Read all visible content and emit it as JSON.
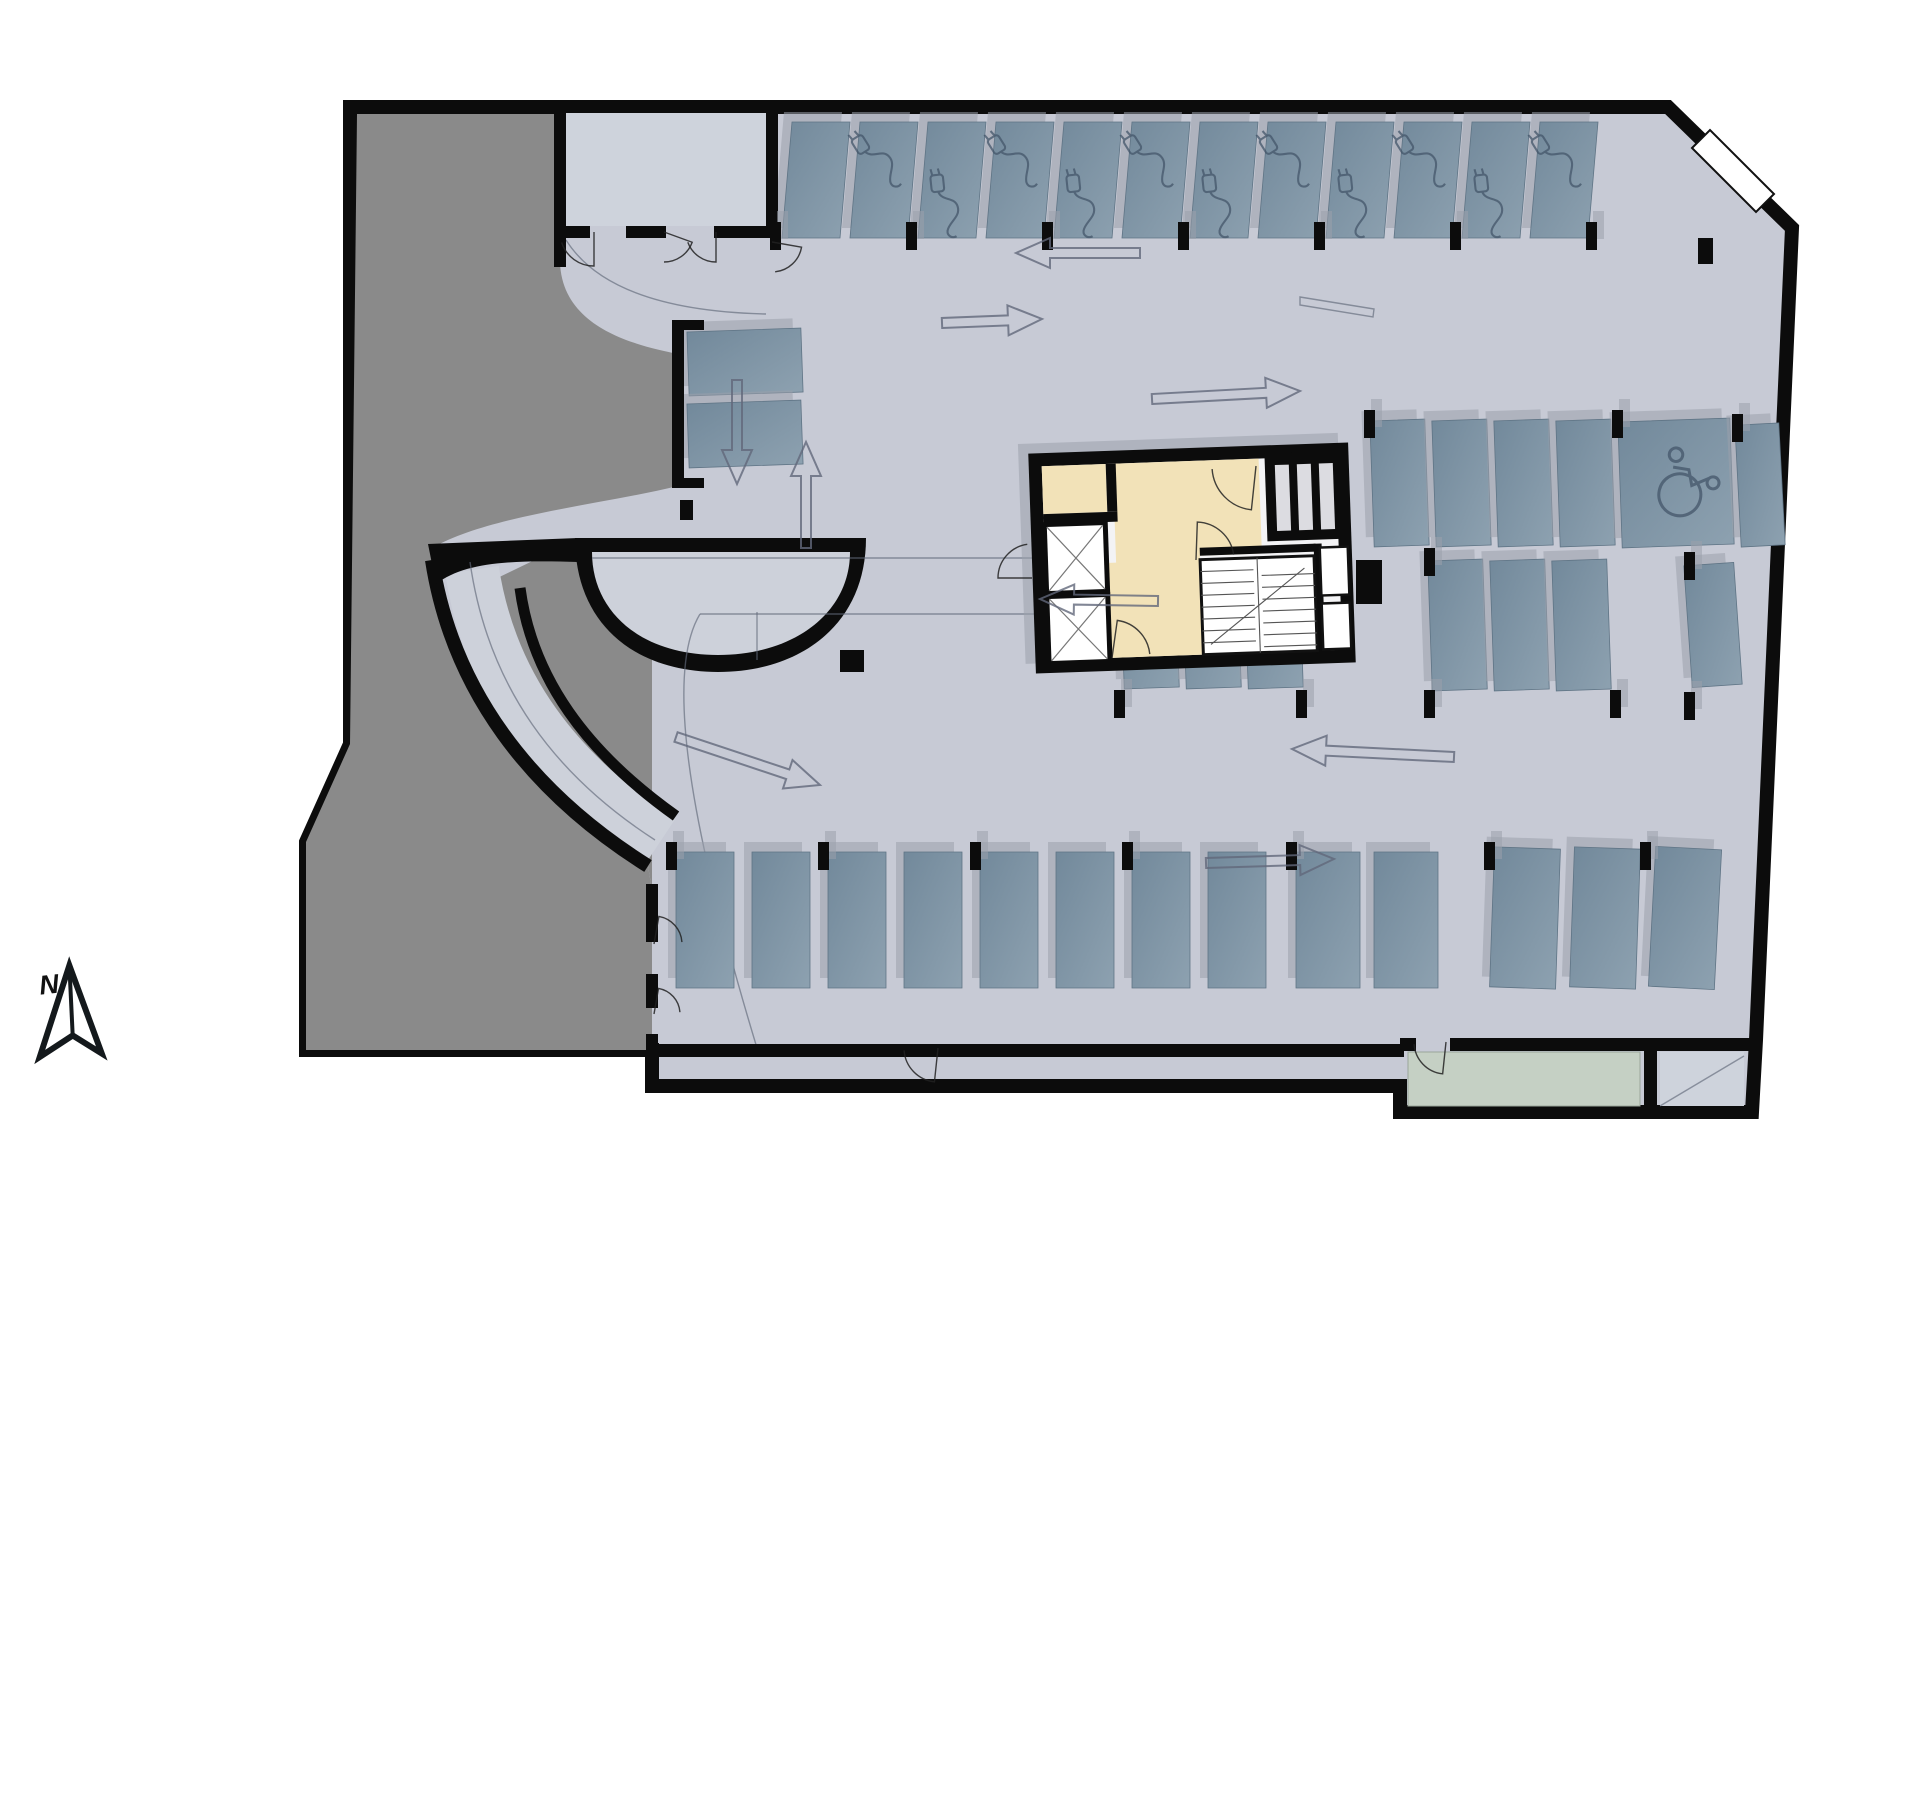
{
  "meta": {
    "type": "parking-garage-floor-plan",
    "compass_label": "N"
  },
  "colors": {
    "floor": "#c7cad5",
    "floor2": "#cdd1da",
    "dark_zone": "#8a8a8a",
    "wall": "#0c0c0c",
    "room": "#ced3dc",
    "green_room": "#c5d0c4",
    "space_dark": "#72899b",
    "space_light": "#8da1b0",
    "shadow": "#9aa0ac",
    "outline_gray": "#61687a",
    "beige": "#f2e2b8",
    "core_floor": "#f3f3f5",
    "icon_stroke": "#44566a",
    "white": "#ffffff"
  },
  "plan": {
    "outline": "M350,107 L1668,107 L1792,228 L1756,1040 L1752,1112 L1400,1112 L1400,1086 L652,1086 L652,1050 L306,1050 L306,842 L350,744 Z",
    "dark_zone": "M357,114 L560,114 L560,262 C562,330 640,346 678,354 L678,486 C600,505 490,515 432,548 C452,690 530,792 648,866 L652,890 L652,1050 L306,1050 L306,842 L350,744 Z",
    "dark_pocket": "M545,555 L652,555 L652,890 L648,866 C540,800 470,690 452,600 Z",
    "roadway": "M472,570 C490,688 558,774 660,842",
    "ramp_wall_outer": "M432,560 C452,690 530,792 648,866",
    "ramp_wall_inner": "M520,588 C532,678 586,752 676,816",
    "wedge": "M428,544 L578,538 L578,562 C510,560 465,562 436,584 Z",
    "bowl_outer": "M575,538 L866,538 C866,625 800,672 718,672 C636,672 575,625 575,538 Z",
    "bowl_inner": "M592,552 L850,552 C850,612 795,655 718,655 C641,655 592,612 592,552 Z",
    "window": "M1692,148 L1710,130 L1774,194 L1756,212 Z",
    "walls": [
      {
        "x": 554,
        "y": 107,
        "w": 12,
        "h": 160
      },
      {
        "x": 766,
        "y": 107,
        "w": 12,
        "h": 131
      },
      {
        "x": 560,
        "y": 226,
        "w": 30,
        "h": 12
      },
      {
        "x": 626,
        "y": 226,
        "w": 40,
        "h": 12
      },
      {
        "x": 714,
        "y": 226,
        "w": 58,
        "h": 12
      },
      {
        "x": 672,
        "y": 320,
        "w": 12,
        "h": 168
      },
      {
        "x": 684,
        "y": 320,
        "w": 20,
        "h": 10
      },
      {
        "x": 684,
        "y": 478,
        "w": 20,
        "h": 10
      },
      {
        "x": 680,
        "y": 500,
        "w": 13,
        "h": 20
      },
      {
        "x": 652,
        "y": 1044,
        "w": 752,
        "h": 13
      },
      {
        "x": 1400,
        "y": 1038,
        "w": 16,
        "h": 13
      },
      {
        "x": 1450,
        "y": 1038,
        "w": 306,
        "h": 13
      },
      {
        "x": 1644,
        "y": 1046,
        "w": 13,
        "h": 62
      },
      {
        "x": 646,
        "y": 884,
        "w": 12,
        "h": 58
      },
      {
        "x": 646,
        "y": 974,
        "w": 12,
        "h": 34
      },
      {
        "x": 646,
        "y": 1034,
        "w": 12,
        "h": 16
      },
      {
        "x": 1356,
        "y": 560,
        "w": 26,
        "h": 44
      },
      {
        "x": 840,
        "y": 650,
        "w": 24,
        "h": 22
      },
      {
        "x": 1698,
        "y": 238,
        "w": 15,
        "h": 26
      }
    ],
    "rooms": [
      {
        "x": 566,
        "y": 113,
        "w": 200,
        "h": 113,
        "cls": "room"
      },
      {
        "x": 1408,
        "y": 1052,
        "w": 232,
        "h": 54,
        "cls": "green"
      },
      {
        "x": 1660,
        "y": 1052,
        "w": 84,
        "h": 54,
        "cls": "room"
      }
    ],
    "curbs": [
      "M592,558 H1336 Q1350,558 1350,572 V600 Q1350,614 1336,614 H700",
      "M700,614 C660,680 700,860 757,1048",
      "M757,612 L757,660",
      "M470,562 C488,688 556,776 655,840",
      "M1300,297 L1374,309 L1373,317 L1300,305 Z",
      "M1660,1106 L1744,1056",
      "M566,240 C600,294 680,312 766,314"
    ]
  },
  "core": {
    "box": {
      "x": 1032,
      "y": 448,
      "w": 320,
      "h": 220
    },
    "rot": -2,
    "beige_path": "M1116,461 L1262,461 L1262,556 L1200,556 L1200,655 L1080,655 L1080,560 L1116,560 Z",
    "beige_room": {
      "x": 1045,
      "y": 461,
      "w": 64,
      "h": 48
    },
    "inner_walls": [
      {
        "x": 1109,
        "y": 461,
        "w": 10,
        "h": 48
      },
      {
        "x": 1045,
        "y": 509,
        "w": 74,
        "h": 10
      },
      {
        "x": 1314,
        "y": 548,
        "w": 8,
        "h": 110
      },
      {
        "x": 1200,
        "y": 548,
        "w": 116,
        "h": 8
      }
    ],
    "elevators": [
      {
        "x": 1048,
        "y": 522,
        "w": 56,
        "h": 64
      },
      {
        "x": 1048,
        "y": 594,
        "w": 56,
        "h": 62
      }
    ],
    "shaft_block": {
      "x": 1268,
      "y": 456,
      "w": 80,
      "h": 88
    },
    "shaft_slots": [
      {
        "x": 1278,
        "y": 468,
        "w": 14,
        "h": 66
      },
      {
        "x": 1300,
        "y": 468,
        "w": 14,
        "h": 66
      },
      {
        "x": 1322,
        "y": 468,
        "w": 14,
        "h": 66
      }
    ],
    "stairs": {
      "x": 1200,
      "y": 560,
      "w": 114,
      "h": 95,
      "flights": 7
    },
    "rooms_right": [
      {
        "x": 1320,
        "y": 552,
        "w": 28,
        "h": 48
      },
      {
        "x": 1320,
        "y": 608,
        "w": 28,
        "h": 46
      }
    ]
  },
  "parking_spaces": [
    {
      "x": 782,
      "y": 122,
      "w": 58,
      "h": 116,
      "lean": 10,
      "rot": 0,
      "icon": null
    },
    {
      "x": 850,
      "y": 122,
      "w": 58,
      "h": 116,
      "lean": 10,
      "rot": 0,
      "icon": "ev-upper"
    },
    {
      "x": 918,
      "y": 122,
      "w": 58,
      "h": 116,
      "lean": 10,
      "rot": 0,
      "icon": "ev-lower"
    },
    {
      "x": 986,
      "y": 122,
      "w": 58,
      "h": 116,
      "lean": 10,
      "rot": 0,
      "icon": "ev-upper"
    },
    {
      "x": 1054,
      "y": 122,
      "w": 58,
      "h": 116,
      "lean": 10,
      "rot": 0,
      "icon": "ev-lower"
    },
    {
      "x": 1122,
      "y": 122,
      "w": 58,
      "h": 116,
      "lean": 10,
      "rot": 0,
      "icon": "ev-upper"
    },
    {
      "x": 1190,
      "y": 122,
      "w": 58,
      "h": 116,
      "lean": 10,
      "rot": 0,
      "icon": "ev-lower"
    },
    {
      "x": 1258,
      "y": 122,
      "w": 58,
      "h": 116,
      "lean": 10,
      "rot": 0,
      "icon": "ev-upper"
    },
    {
      "x": 1326,
      "y": 122,
      "w": 58,
      "h": 116,
      "lean": 10,
      "rot": 0,
      "icon": "ev-lower"
    },
    {
      "x": 1394,
      "y": 122,
      "w": 58,
      "h": 116,
      "lean": 10,
      "rot": 0,
      "icon": "ev-upper"
    },
    {
      "x": 1462,
      "y": 122,
      "w": 58,
      "h": 116,
      "lean": 10,
      "rot": 0,
      "icon": "ev-lower"
    },
    {
      "x": 1530,
      "y": 122,
      "w": 58,
      "h": 116,
      "lean": 10,
      "rot": 0,
      "icon": "ev-upper"
    },
    {
      "x": 676,
      "y": 852,
      "w": 58,
      "h": 136,
      "lean": 0,
      "rot": 0,
      "icon": null
    },
    {
      "x": 752,
      "y": 852,
      "w": 58,
      "h": 136,
      "lean": 0,
      "rot": 0,
      "icon": null
    },
    {
      "x": 828,
      "y": 852,
      "w": 58,
      "h": 136,
      "lean": 0,
      "rot": 0,
      "icon": null
    },
    {
      "x": 904,
      "y": 852,
      "w": 58,
      "h": 136,
      "lean": 0,
      "rot": 0,
      "icon": null
    },
    {
      "x": 980,
      "y": 852,
      "w": 58,
      "h": 136,
      "lean": 0,
      "rot": 0,
      "icon": null
    },
    {
      "x": 1056,
      "y": 852,
      "w": 58,
      "h": 136,
      "lean": 0,
      "rot": 0,
      "icon": null
    },
    {
      "x": 1132,
      "y": 852,
      "w": 58,
      "h": 136,
      "lean": 0,
      "rot": 0,
      "icon": null
    },
    {
      "x": 1208,
      "y": 852,
      "w": 58,
      "h": 136,
      "lean": 0,
      "rot": 0,
      "icon": null
    },
    {
      "x": 1296,
      "y": 852,
      "w": 64,
      "h": 136,
      "lean": 0,
      "rot": 0,
      "icon": null
    },
    {
      "x": 1374,
      "y": 852,
      "w": 64,
      "h": 136,
      "lean": 0,
      "rot": 0,
      "icon": null
    },
    {
      "x": 1492,
      "y": 848,
      "w": 66,
      "h": 140,
      "lean": 0,
      "rot": 2,
      "icon": null
    },
    {
      "x": 1572,
      "y": 848,
      "w": 66,
      "h": 140,
      "lean": 0,
      "rot": 2,
      "icon": null
    },
    {
      "x": 1652,
      "y": 848,
      "w": 66,
      "h": 140,
      "lean": 0,
      "rot": 3,
      "icon": null
    },
    {
      "x": 1372,
      "y": 420,
      "w": 55,
      "h": 126,
      "lean": 0,
      "rot": -2,
      "icon": null
    },
    {
      "x": 1434,
      "y": 420,
      "w": 55,
      "h": 126,
      "lean": 0,
      "rot": -2,
      "icon": null
    },
    {
      "x": 1496,
      "y": 420,
      "w": 55,
      "h": 126,
      "lean": 0,
      "rot": -2,
      "icon": null
    },
    {
      "x": 1558,
      "y": 420,
      "w": 55,
      "h": 126,
      "lean": 0,
      "rot": -2,
      "icon": null
    },
    {
      "x": 1620,
      "y": 420,
      "w": 112,
      "h": 126,
      "lean": 0,
      "rot": -2,
      "icon": "wheelchair"
    },
    {
      "x": 1738,
      "y": 424,
      "w": 44,
      "h": 122,
      "lean": 0,
      "rot": -3,
      "icon": null
    },
    {
      "x": 1122,
      "y": 558,
      "w": 55,
      "h": 130,
      "lean": 0,
      "rot": -2,
      "icon": null
    },
    {
      "x": 1184,
      "y": 558,
      "w": 55,
      "h": 130,
      "lean": 0,
      "rot": -2,
      "icon": null
    },
    {
      "x": 1246,
      "y": 558,
      "w": 55,
      "h": 130,
      "lean": 0,
      "rot": -2,
      "icon": null
    },
    {
      "x": 1430,
      "y": 560,
      "w": 55,
      "h": 130,
      "lean": 0,
      "rot": -2,
      "icon": null
    },
    {
      "x": 1492,
      "y": 560,
      "w": 55,
      "h": 130,
      "lean": 0,
      "rot": -2,
      "icon": null
    },
    {
      "x": 1554,
      "y": 560,
      "w": 55,
      "h": 130,
      "lean": 0,
      "rot": -2,
      "icon": null
    },
    {
      "x": 1688,
      "y": 564,
      "w": 50,
      "h": 122,
      "lean": 0,
      "rot": -4,
      "icon": null
    },
    {
      "x": 688,
      "y": 330,
      "w": 114,
      "h": 64,
      "lean": 0,
      "rot": -2,
      "icon": null
    },
    {
      "x": 688,
      "y": 402,
      "w": 114,
      "h": 64,
      "lean": 0,
      "rot": -2,
      "icon": null
    }
  ],
  "columns": [
    {
      "x": 770,
      "y": 222
    },
    {
      "x": 906,
      "y": 222
    },
    {
      "x": 1042,
      "y": 222
    },
    {
      "x": 1178,
      "y": 222
    },
    {
      "x": 1314,
      "y": 222
    },
    {
      "x": 1450,
      "y": 222
    },
    {
      "x": 1586,
      "y": 222
    },
    {
      "x": 666,
      "y": 842
    },
    {
      "x": 818,
      "y": 842
    },
    {
      "x": 970,
      "y": 842
    },
    {
      "x": 1122,
      "y": 842
    },
    {
      "x": 1286,
      "y": 842
    },
    {
      "x": 1484,
      "y": 842
    },
    {
      "x": 1640,
      "y": 842
    },
    {
      "x": 1364,
      "y": 410
    },
    {
      "x": 1612,
      "y": 410
    },
    {
      "x": 1732,
      "y": 414
    },
    {
      "x": 1114,
      "y": 690
    },
    {
      "x": 1296,
      "y": 690
    },
    {
      "x": 1424,
      "y": 690
    },
    {
      "x": 1610,
      "y": 690
    },
    {
      "x": 1684,
      "y": 692
    },
    {
      "x": 1424,
      "y": 548
    },
    {
      "x": 1684,
      "y": 552
    }
  ],
  "arrows": [
    {
      "x1": 1140,
      "y1": 253,
      "x2": 1016,
      "y2": 253
    },
    {
      "x1": 942,
      "y1": 323,
      "x2": 1042,
      "y2": 319
    },
    {
      "x1": 737,
      "y1": 380,
      "x2": 737,
      "y2": 484
    },
    {
      "x1": 806,
      "y1": 548,
      "x2": 806,
      "y2": 442
    },
    {
      "x1": 1152,
      "y1": 399,
      "x2": 1300,
      "y2": 391
    },
    {
      "x1": 1158,
      "y1": 601,
      "x2": 1040,
      "y2": 599
    },
    {
      "x1": 676,
      "y1": 737,
      "x2": 820,
      "y2": 785
    },
    {
      "x1": 1454,
      "y1": 757,
      "x2": 1292,
      "y2": 749
    },
    {
      "x1": 1206,
      "y1": 863,
      "x2": 1334,
      "y2": 859
    }
  ],
  "door_arcs": [
    {
      "cx": 594,
      "cy": 232,
      "r": 34,
      "a0": 90,
      "a1": 162
    },
    {
      "cx": 664,
      "cy": 232,
      "r": 30,
      "a0": 20,
      "a1": 90
    },
    {
      "cx": 716,
      "cy": 232,
      "r": 30,
      "a0": 90,
      "a1": 160
    },
    {
      "cx": 772,
      "cy": 242,
      "r": 30,
      "a0": 10,
      "a1": 84
    },
    {
      "cx": 1032,
      "cy": 578,
      "r": 34,
      "a0": 180,
      "a1": 262
    },
    {
      "cx": 1256,
      "cy": 466,
      "r": 44,
      "a0": 96,
      "a1": 176
    },
    {
      "cx": 1196,
      "cy": 560,
      "r": 38,
      "a0": 272,
      "a1": 352
    },
    {
      "cx": 1112,
      "cy": 658,
      "r": 38,
      "a0": 278,
      "a1": 354
    },
    {
      "cx": 938,
      "cy": 1048,
      "r": 34,
      "a0": 96,
      "a1": 176
    },
    {
      "cx": 1446,
      "cy": 1042,
      "r": 32,
      "a0": 96,
      "a1": 176
    },
    {
      "cx": 654,
      "cy": 944,
      "r": 28,
      "a0": 280,
      "a1": 356
    },
    {
      "cx": 654,
      "cy": 1014,
      "r": 26,
      "a0": 280,
      "a1": 356
    }
  ],
  "compass": {
    "body": "M74,966 L35,1054 L70,1036 L97,1057 Z",
    "spine": "M74,966 L70,1036"
  }
}
